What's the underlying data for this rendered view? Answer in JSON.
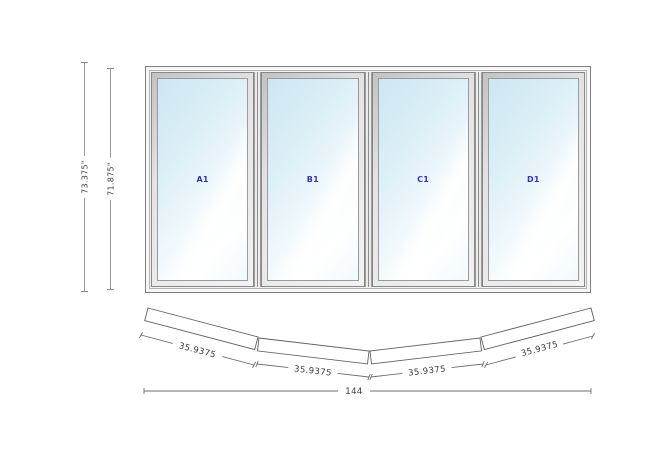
{
  "elevation": {
    "panels": [
      {
        "label": "A1"
      },
      {
        "label": "B1"
      },
      {
        "label": "C1"
      },
      {
        "label": "D1"
      }
    ],
    "height_dims": [
      {
        "label": "73.375\""
      },
      {
        "label": "71.875\""
      }
    ]
  },
  "plan": {
    "segment_dims": [
      {
        "label": "35.9375"
      },
      {
        "label": "35.9375"
      },
      {
        "label": "35.9375"
      },
      {
        "label": "35.9375"
      }
    ],
    "total_width": {
      "label": "144"
    }
  },
  "colors": {
    "panel_label": "#3333cc",
    "dimension_text": "#3a3a3a",
    "drawing_line": "#6e6e6e",
    "glass_tint": "#cde7f1"
  }
}
